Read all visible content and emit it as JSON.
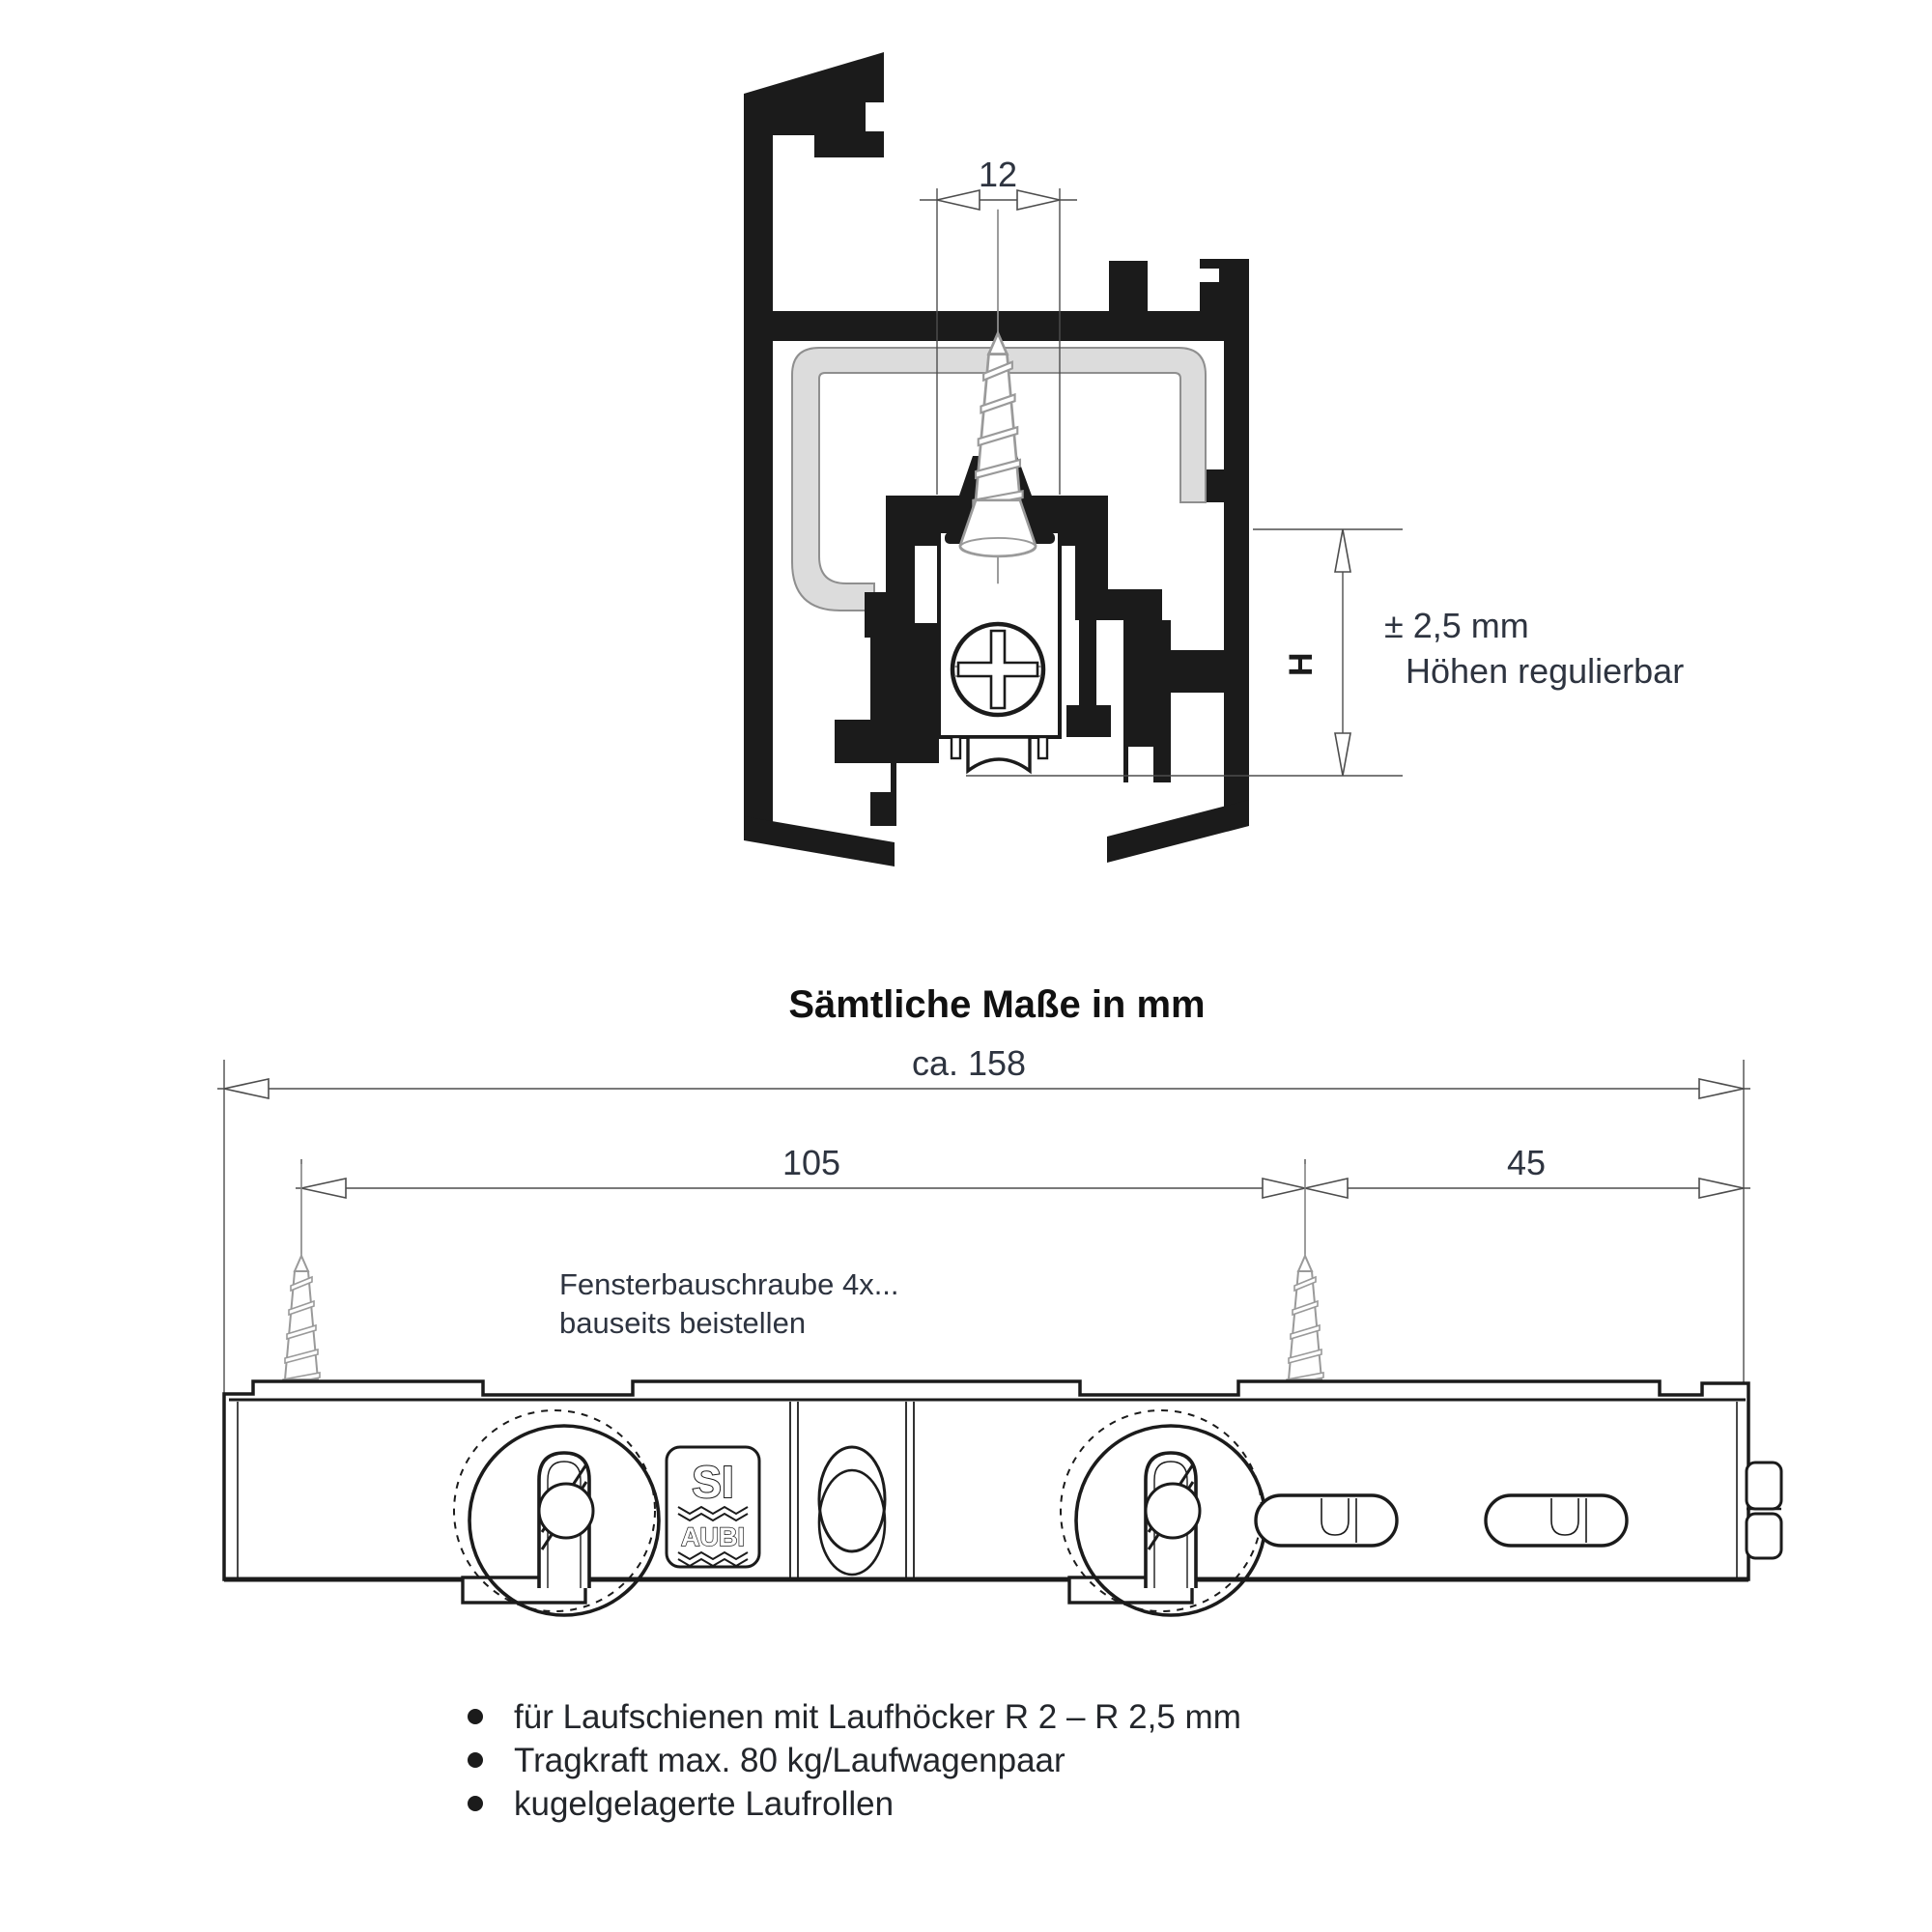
{
  "caption": "Sämtliche Maße in mm",
  "top_drawing": {
    "dim_width": "12",
    "height_label": "H",
    "tolerance_value": "± 2,5 mm",
    "tolerance_desc": "Höhen regulierbar"
  },
  "bottom_drawing": {
    "dim_total": "ca. 158",
    "dim_screw_spacing": "105",
    "dim_end": "45",
    "screw_note_line1": "Fensterbauschraube 4x...",
    "screw_note_line2": "bauseits beistellen",
    "logo_line1": "SI",
    "logo_line2": "AUBI"
  },
  "features": [
    "für Laufschienen mit Laufhöcker R 2 – R 2,5 mm",
    "Tragkraft max. 80 kg/Laufwagenpaar",
    "kugelgelagerte Laufrollen"
  ],
  "colors": {
    "line": "#1b1b1b",
    "dimension": "#2e3440",
    "screw_gray": "#9a9a9a",
    "gasket_gray": "#dcdcdc"
  }
}
